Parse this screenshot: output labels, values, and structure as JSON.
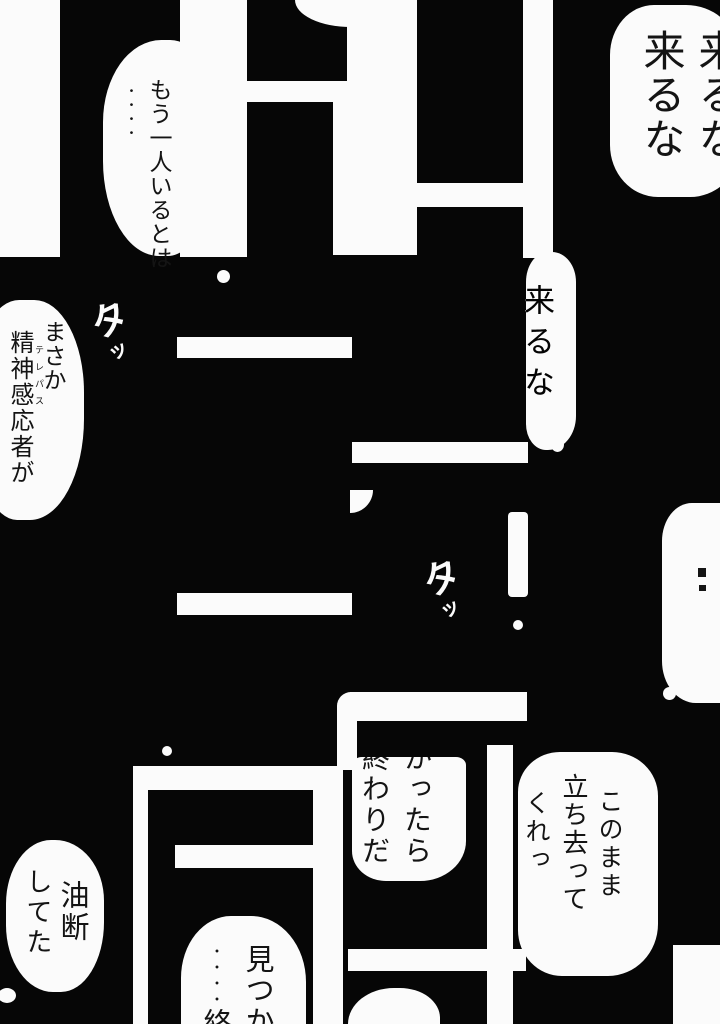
{
  "colors": {
    "paper": "#fbfbfb",
    "ink": "#141414",
    "background": "#060606"
  },
  "bubbles": {
    "top_right": {
      "col1": "来るな",
      "col2": "来るな"
    },
    "top_left": {
      "col1": "もう一人いるとは",
      "col2_dots": "・・・・"
    },
    "telepath": {
      "col1": "まさか",
      "col2": "精神感応者が",
      "ruby": "テレパス"
    },
    "mid_come": {
      "col1": "来るな"
    },
    "owari": {
      "col1": "かったら",
      "col2": "終わりだ"
    },
    "leave": {
      "col1": "このまま",
      "col2": "立ち去って",
      "col3": "くれっ"
    },
    "yudan": {
      "col1": "油断",
      "col2": "してた"
    },
    "mitsuka": {
      "col1": "見つか",
      "col2_dots": "・・・・",
      "col2_char": "終"
    }
  },
  "sfx": {
    "step1": {
      "big": "タ",
      "small": "ッ"
    },
    "step2": {
      "big": "タ",
      "small": "ッ"
    }
  }
}
